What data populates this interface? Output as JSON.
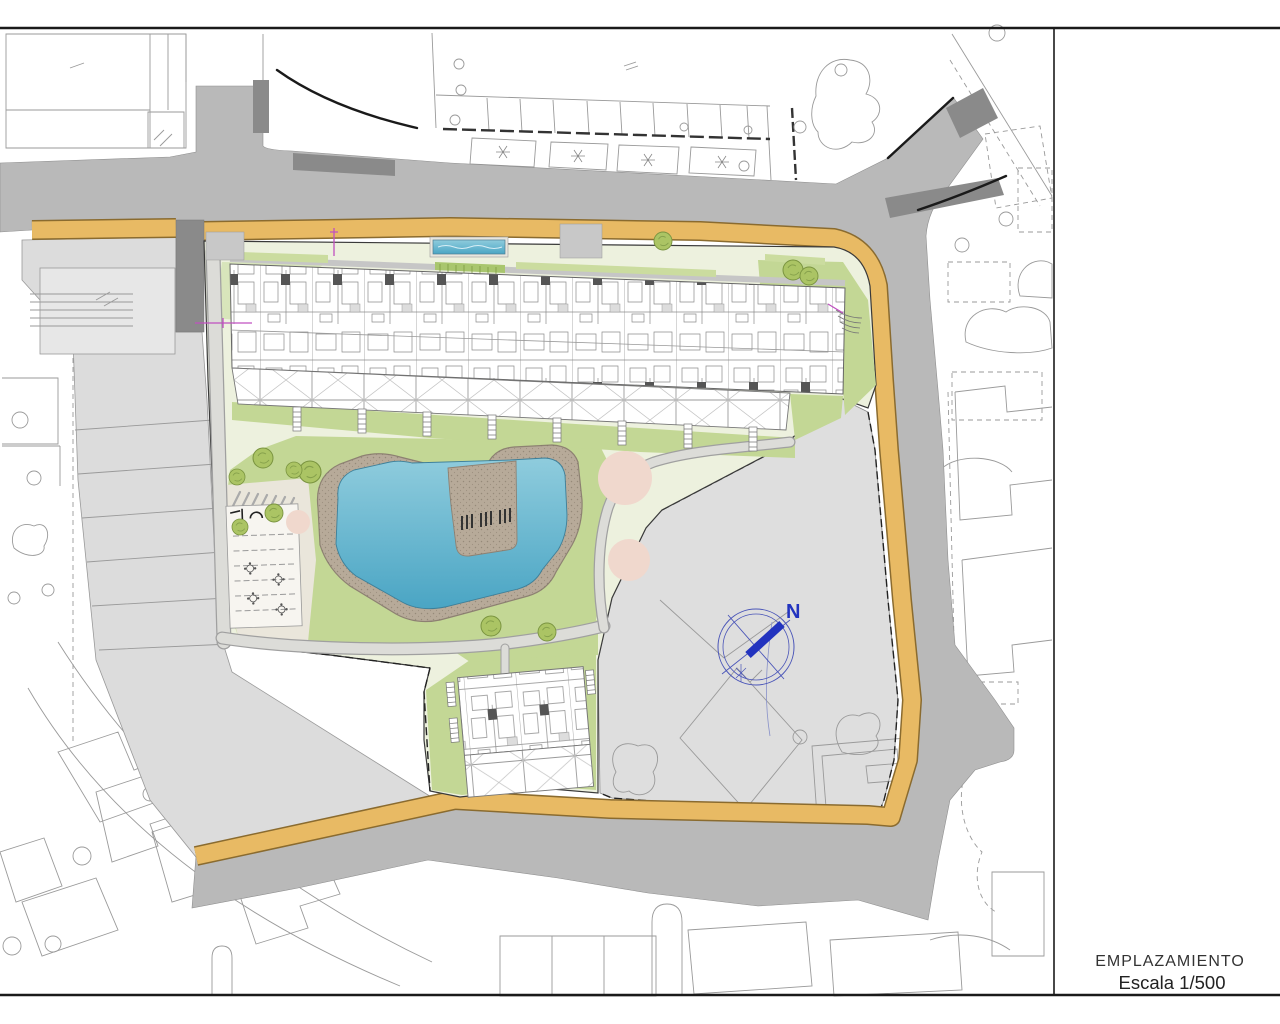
{
  "title_block": {
    "title": "EMPLAZAMIENTO",
    "scale": "Escala 1/500"
  },
  "compass": {
    "north_label": "N"
  },
  "colors": {
    "road": "#b9b9b9",
    "darkpatch": "#8a8a8a",
    "sidewalk": "#e8ba64",
    "sidewalkedge": "#8a6b2f",
    "site": "#edf1de",
    "lawn": "#c3d795",
    "lawnlight": "#d8e5bb",
    "warm": "#eae6db",
    "pool": "#55aecb",
    "poollight": "#8fccdd",
    "deck": "#b7aa99",
    "deckedge": "#8d8172",
    "tree": "#abc464",
    "treeedge": "#7a9440",
    "pinktree": "#f0d8cd",
    "parcel": "#dcdcdc",
    "parcelbldg": "#e7e7e7",
    "walk": "#dcdcd8",
    "outline": "#9a9a9a",
    "frame": "#1a1a1a",
    "compassblue": "#2233bf",
    "magenta": "#c050c0",
    "buildingline": "#8c8c8c"
  }
}
